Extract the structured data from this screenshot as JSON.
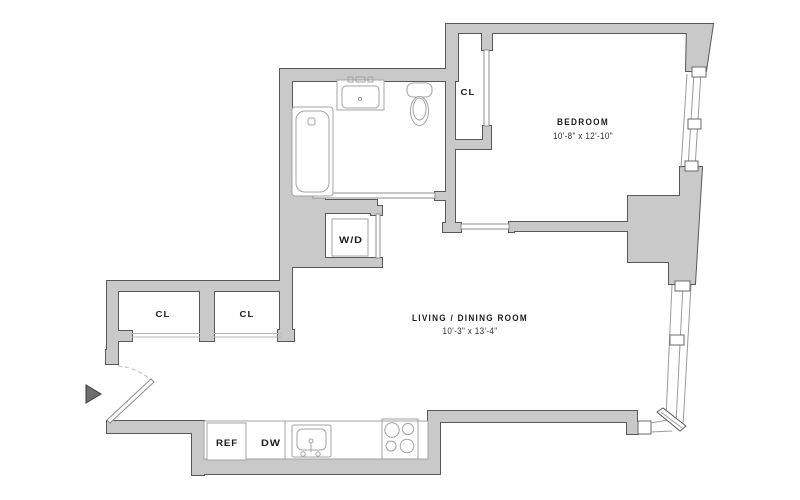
{
  "plan_title": "Apartment floor plan",
  "rooms": {
    "bedroom": {
      "label": "BEDROOM",
      "dims": "10'-8\" x 12'-10\""
    },
    "living": {
      "label": "LIVING / DINING ROOM",
      "dims": "10'-3\" x 13'-4\""
    }
  },
  "closets": {
    "bedroom_closet": "CL",
    "left": "CL",
    "right": "CL"
  },
  "appliances": {
    "washer_dryer": "W/D",
    "refrigerator": "REF",
    "dishwasher": "DW"
  },
  "colors": {
    "background": "#ffffff",
    "wall_fill": "#c9c9c9",
    "wall_outline": "#585858",
    "fixture_line": "#a3a3a3",
    "text": "#1c1c1c"
  }
}
